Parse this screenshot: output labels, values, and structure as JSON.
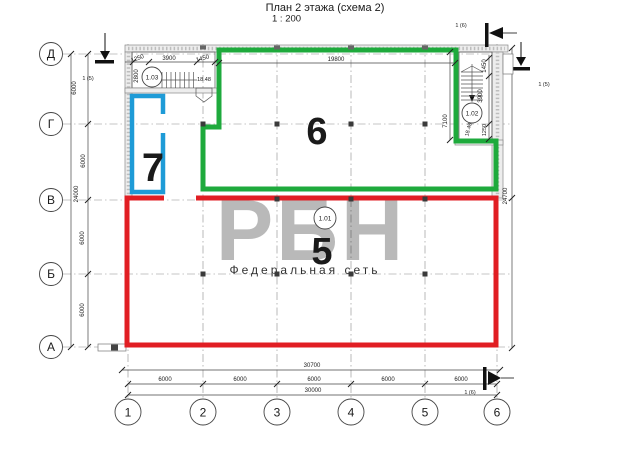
{
  "title": {
    "main": "План 2 этажа (схема 2)",
    "scale": "1 : 200"
  },
  "watermark": {
    "big": "РБН",
    "small": "Федеральная сеть"
  },
  "colors": {
    "red": "#E11E23",
    "green": "#1EAA3C",
    "blue": "#1E9BD7"
  },
  "axes": {
    "rows": [
      {
        "label": "Д",
        "y": 54
      },
      {
        "label": "Г",
        "y": 124
      },
      {
        "label": "В",
        "y": 200
      },
      {
        "label": "Б",
        "y": 274
      },
      {
        "label": "А",
        "y": 347
      }
    ],
    "cols": [
      {
        "label": "1",
        "x": 128
      },
      {
        "label": "2",
        "x": 203
      },
      {
        "label": "3",
        "x": 277
      },
      {
        "label": "4",
        "x": 351
      },
      {
        "label": "5",
        "x": 425
      },
      {
        "label": "6",
        "x": 497
      }
    ]
  },
  "zones": [
    {
      "label": "5",
      "x": 322,
      "y": 264,
      "size": 38,
      "color_key": "red"
    },
    {
      "label": "6",
      "x": 317,
      "y": 144,
      "size": 38,
      "color_key": "green"
    },
    {
      "label": "7",
      "x": 153,
      "y": 181,
      "size": 40,
      "color_key": "blue"
    }
  ],
  "room_tags": [
    {
      "label": "1.03",
      "x": 152,
      "y": 77,
      "r": 10
    },
    {
      "label": "1.02",
      "x": 472,
      "y": 113,
      "r": 10
    },
    {
      "label": "1.01",
      "x": 325,
      "y": 218,
      "r": 11
    }
  ],
  "dim_labels": [
    {
      "t": "1250",
      "x": 138,
      "y": 60,
      "r": -20,
      "s": 6
    },
    {
      "t": "3900",
      "x": 169,
      "y": 60,
      "r": 0,
      "s": 6
    },
    {
      "t": "1450",
      "x": 203,
      "y": 60,
      "r": -15,
      "s": 6
    },
    {
      "t": "19800",
      "x": 336,
      "y": 61,
      "r": 0,
      "s": 6
    },
    {
      "t": "2800",
      "x": 138,
      "y": 76,
      "r": -90,
      "s": 6
    },
    {
      "t": "6000",
      "x": 76,
      "y": 88,
      "r": -90,
      "s": 6
    },
    {
      "t": "1 (5)",
      "x": 88,
      "y": 80,
      "r": 0,
      "s": 5.5
    },
    {
      "t": "6000",
      "x": 85,
      "y": 161,
      "r": -90,
      "s": 6
    },
    {
      "t": "24000",
      "x": 78,
      "y": 194,
      "r": -90,
      "s": 6
    },
    {
      "t": "6000",
      "x": 84,
      "y": 238,
      "r": -90,
      "s": 6
    },
    {
      "t": "6000",
      "x": 84,
      "y": 310,
      "r": -90,
      "s": 6
    },
    {
      "t": "7100",
      "x": 447,
      "y": 121,
      "r": -90,
      "s": 6
    },
    {
      "t": "1450",
      "x": 486,
      "y": 66,
      "r": -90,
      "s": 6
    },
    {
      "t": "3900",
      "x": 482,
      "y": 96,
      "r": -90,
      "s": 6
    },
    {
      "t": "1250",
      "x": 486,
      "y": 130,
      "r": -90,
      "s": 5.5
    },
    {
      "t": "18.48",
      "x": 470,
      "y": 130,
      "r": -75,
      "s": 5.5
    },
    {
      "t": "18.48",
      "x": 204,
      "y": 81,
      "r": 0,
      "s": 5.5
    },
    {
      "t": "24700",
      "x": 507,
      "y": 196,
      "r": -90,
      "s": 6
    },
    {
      "t": "1 (5)",
      "x": 544,
      "y": 86,
      "r": 0,
      "s": 5.5
    },
    {
      "t": "30700",
      "x": 312,
      "y": 367,
      "r": 0,
      "s": 6
    },
    {
      "t": "6000",
      "x": 165,
      "y": 381,
      "r": 0,
      "s": 6
    },
    {
      "t": "6000",
      "x": 240,
      "y": 381,
      "r": 0,
      "s": 6
    },
    {
      "t": "6000",
      "x": 314,
      "y": 381,
      "r": 0,
      "s": 6
    },
    {
      "t": "6000",
      "x": 388,
      "y": 381,
      "r": 0,
      "s": 6
    },
    {
      "t": "6000",
      "x": 461,
      "y": 381,
      "r": 0,
      "s": 6
    },
    {
      "t": "30000",
      "x": 313,
      "y": 392,
      "r": 0,
      "s": 6
    },
    {
      "t": "1 (6)",
      "x": 470,
      "y": 394,
      "r": 0,
      "s": 5.5
    },
    {
      "t": "1 (6)",
      "x": 461,
      "y": 27,
      "r": 0,
      "s": 5.5
    }
  ]
}
